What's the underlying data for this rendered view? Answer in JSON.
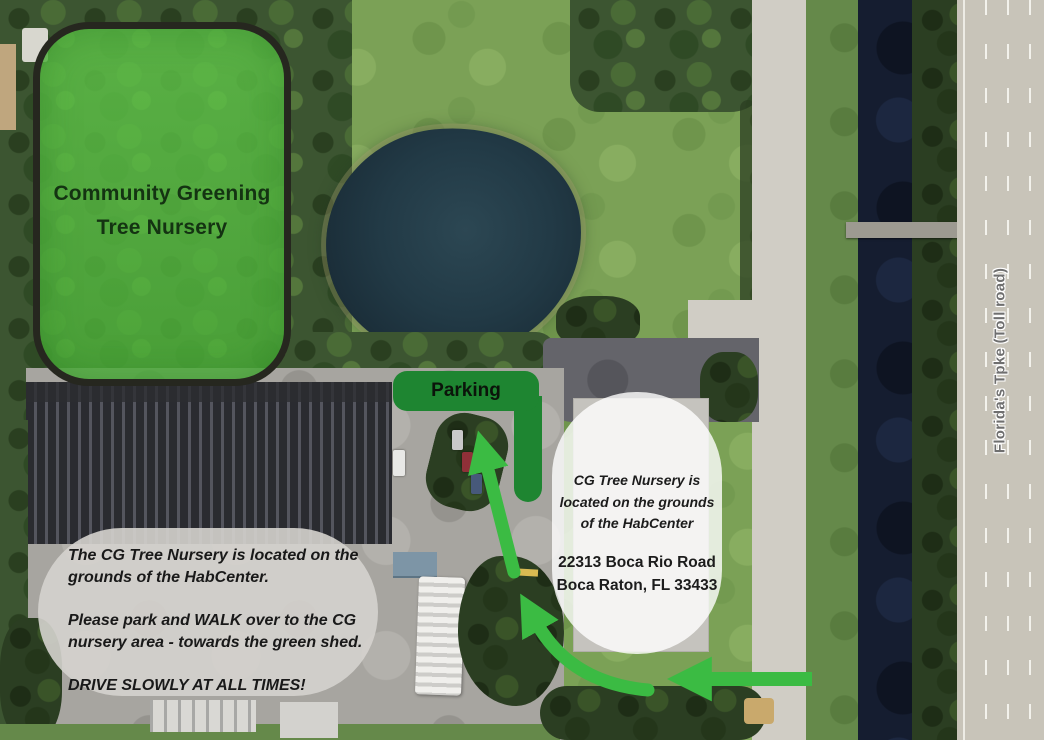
{
  "nursery": {
    "line1": "Community Greening",
    "line2": "Tree Nursery"
  },
  "parking": {
    "label": "Parking"
  },
  "info_bubble": {
    "line1": "CG Tree Nursery is",
    "line2": "located on the grounds",
    "line3": "of the HabCenter",
    "address1": "22313 Boca Rio Road",
    "address2": "Boca Raton, FL 33433"
  },
  "note_bubble": {
    "p1a": "The CG Tree Nursery is located on the",
    "p1b": "grounds of the HabCenter.",
    "p2a": "Please park and WALK over to the CG",
    "p2b": "nursery area - towards the green shed.",
    "p3": "DRIVE SLOWLY AT ALL TIMES!"
  },
  "highway": {
    "label": "Florida's Tpke (Toll road)"
  },
  "colors": {
    "highlight_green": "#5fc24a",
    "parking_green": "#1e8531",
    "arrow_green": "#3bbb43",
    "canal_navy": "#151d30",
    "pond_blue": "#223a46"
  }
}
